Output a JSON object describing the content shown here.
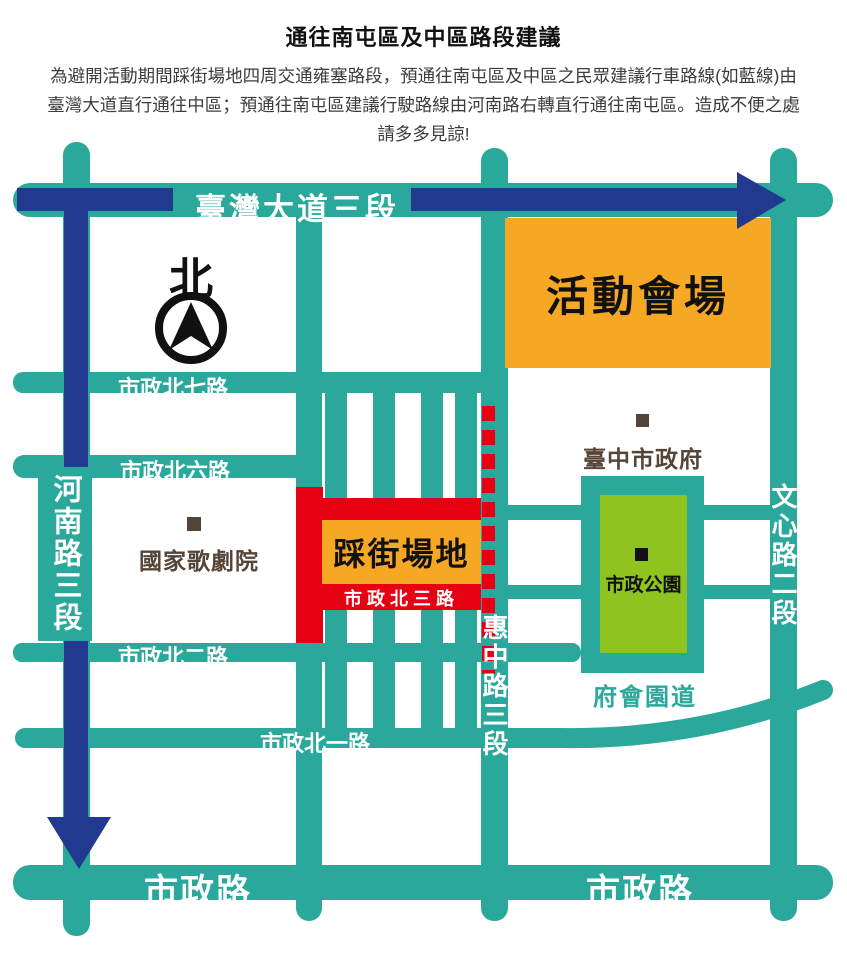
{
  "header": {
    "title": "通往南屯區及中區路段建議",
    "description": "為避開活動期間踩街場地四周交通雍塞路段，預通往南屯區及中區之民眾建議行車路線(如藍線)由臺灣大道直行通往中區；預通往南屯區建議行駛路線由河南路右轉直行通往南屯區。造成不便之處請多多見諒!"
  },
  "compass": {
    "north_label": "北"
  },
  "roads": {
    "taiwan_blvd": "臺灣大道三段",
    "henan": "河南路三段",
    "huizhong": "惠中路三段",
    "wenxin": "文心路二段",
    "n7": "市政北七路",
    "n6": "市政北六路",
    "n3": "市政北三路",
    "n2": "市政北二路",
    "n1": "市政北一路",
    "shizheng": "市政路",
    "fuhui": "府會園道"
  },
  "places": {
    "event_venue": "活動會場",
    "parade_ground": "踩街場地",
    "opera_house": "國家歌劇院",
    "city_hall": "臺中市政府",
    "city_park": "市政公園"
  },
  "colors": {
    "teal": "#2AA89B",
    "blue": "#21398F",
    "red": "#E60012",
    "orange": "#F6A723",
    "green": "#8FC31F",
    "brown": "#554539",
    "ink": "#111111",
    "body": "#3C3C3C"
  }
}
